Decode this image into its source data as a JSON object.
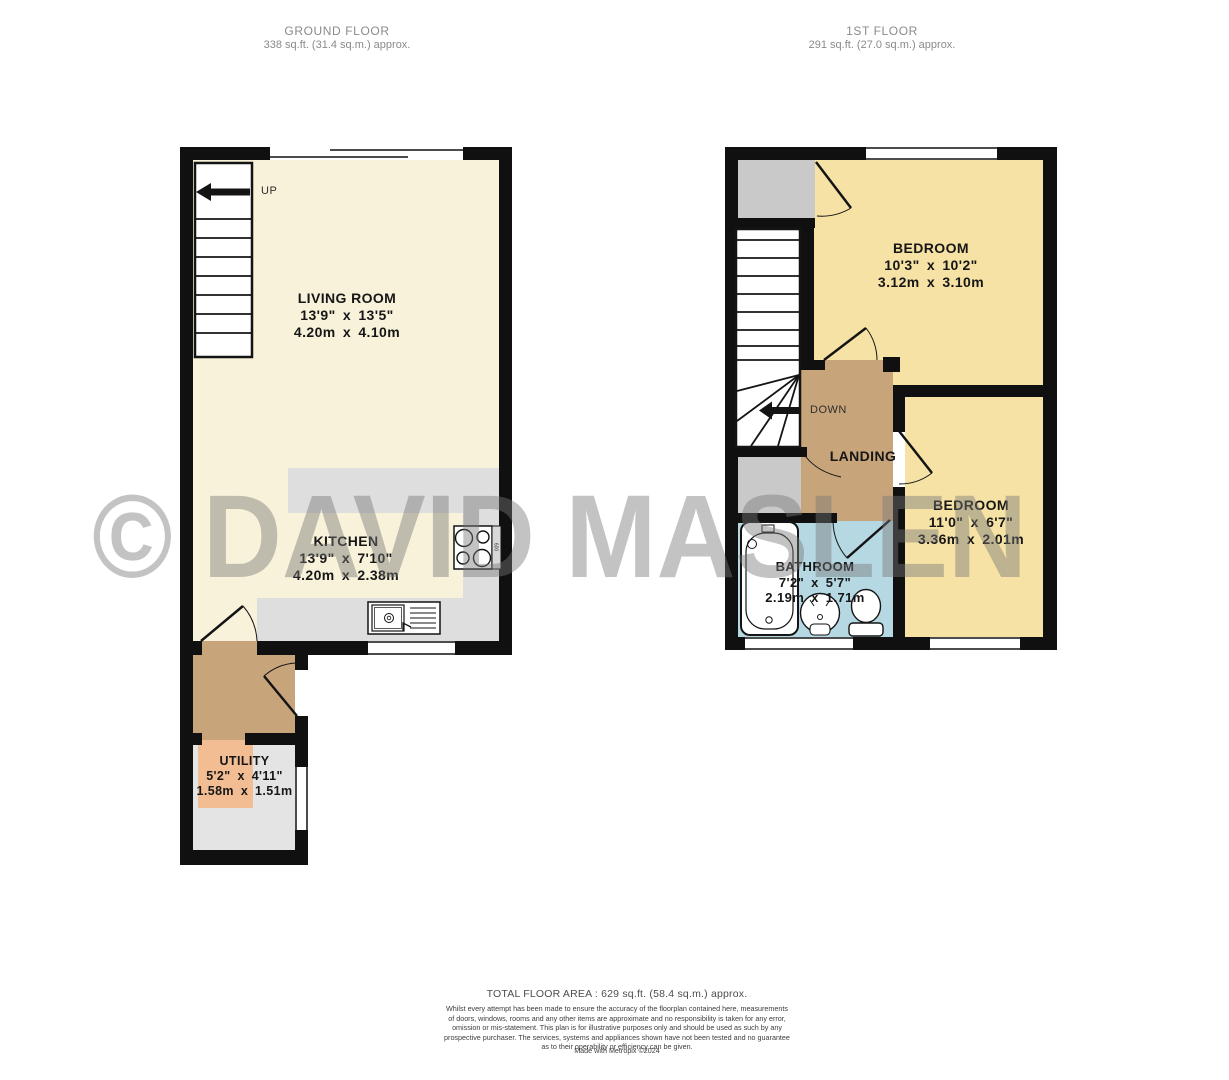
{
  "headers": {
    "ground_floor": {
      "title": "GROUND FLOOR",
      "area": "338 sq.ft. (31.4 sq.m.) approx."
    },
    "first_floor": {
      "title": "1ST FLOOR",
      "area": "291 sq.ft. (27.0 sq.m.) approx."
    }
  },
  "rooms": {
    "living_room": {
      "name": "LIVING ROOM",
      "imperial": "13'9\" x 13'5\"",
      "metric": "4.20m x 4.10m"
    },
    "kitchen": {
      "name": "KITCHEN",
      "imperial": "13'9\" x 7'10\"",
      "metric": "4.20m x 2.38m"
    },
    "utility": {
      "name": "UTILITY",
      "imperial": "5'2\" x 4'11\"",
      "metric": "1.58m x 1.51m"
    },
    "bedroom_1": {
      "name": "BEDROOM",
      "imperial": "10'3\" x 10'2\"",
      "metric": "3.12m x 3.10m"
    },
    "bedroom_2": {
      "name": "BEDROOM",
      "imperial": "11'0\" x 6'7\"",
      "metric": "3.36m x 2.01m"
    },
    "bathroom": {
      "name": "BATHROOM",
      "imperial": "7'2\" x 5'7\"",
      "metric": "2.19m x 1.71m"
    },
    "landing": {
      "name": "LANDING"
    }
  },
  "stairs": {
    "up_label": "UP",
    "down_label": "DOWN"
  },
  "appliances": {
    "hob_size_label": "600"
  },
  "watermark": "© DAVID MASLEN",
  "footer": {
    "total_area": "TOTAL FLOOR AREA : 629 sq.ft. (58.4 sq.m.) approx.",
    "disclaimer_lines": [
      "Whilst every attempt has been made to ensure the accuracy of the floorplan contained here, measurements",
      "of doors, windows, rooms and any other items are approximate and no responsibility is taken for any error,",
      "omission or mis-statement. This plan is for illustrative purposes only and should be used as such by any",
      "prospective purchaser. The services, systems and appliances shown have not been tested and no guarantee",
      "as to their operability or efficiency can be given."
    ],
    "made_with": "Made with Metropix ©2024"
  },
  "colors": {
    "wall": "#101010",
    "living_kitchen_floor": "#f8f2da",
    "bedroom_floor": "#f5e2a4",
    "hall_landing_floor": "#c8a47a",
    "utility_accent": "#f2bd92",
    "utility_floor": "#e4e4e4",
    "counter_gray": "#dedede",
    "closet_gray": "#c9c9c9",
    "bathroom_floor": "#b5d8e3",
    "watermark_gray": "#787878",
    "header_text": "#8a8a8a"
  }
}
